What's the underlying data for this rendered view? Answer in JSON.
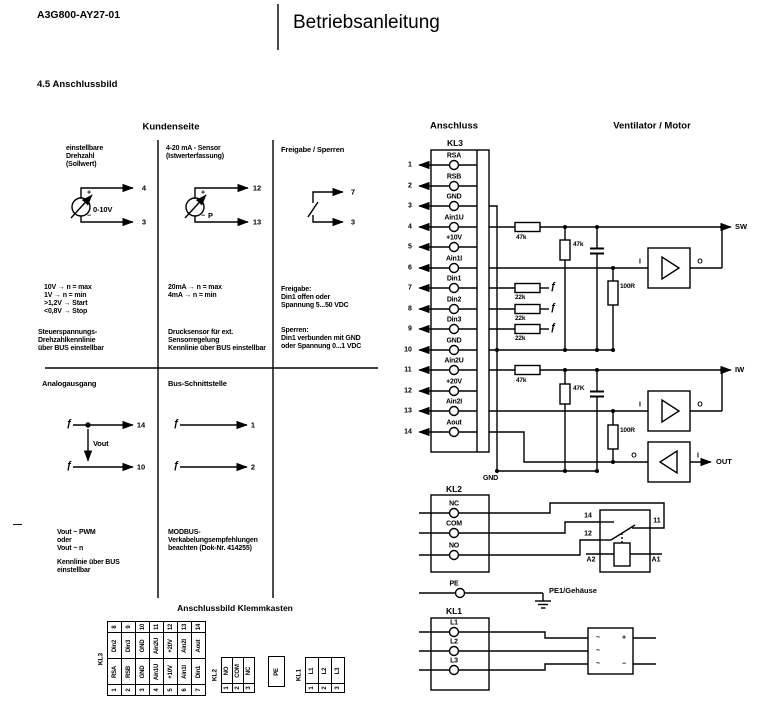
{
  "header": {
    "doc_number": "A3G800-AY27-01",
    "title": "Betriebsanleitung"
  },
  "section_title": "4.5 Anschlussbild",
  "glyphs": {
    "switch": "ƒ",
    "plus": "+",
    "minus": "−",
    "tilde": "~",
    "dash": "—"
  },
  "kundenseite": {
    "heading": "Kundenseite",
    "setpoint": {
      "heading": "einstellbare\nDrehzahl\n(Sollwert)",
      "pot_label": "0-10V",
      "pin_top": "4",
      "pin_bottom": "3",
      "values": "10V  → n = max\n1V  → n = min\n>1,2V → Start\n<0,8V → Stop",
      "note": "Steuerspannungs-\nDrehzahlkennlinie\nüber BUS einstellbar"
    },
    "sensor": {
      "heading": "4-20 mA - Sensor\n(Istwerterfassung)",
      "sensor_label": "P",
      "pin_top": "12",
      "pin_bottom": "13",
      "values": "20mA  → n = max\n4mA  → n = min",
      "note": "Drucksensor für ext.\nSensorregelung\nKennlinie über BUS einstellbar"
    },
    "enable": {
      "heading": "Freigabe / Sperren",
      "pin_top": "7",
      "pin_bottom": "3",
      "values": "Freigabe:\nDin1 offen oder\nSpannung 5...50 VDC",
      "note": "Sperren:\nDin1 verbunden mit GND\noder Spannung 0...1 VDC"
    },
    "analog_out": {
      "heading": "Analogausgang",
      "pin_top": "14",
      "pin_bottom": "10",
      "vout": "Vout",
      "note": "Vout ~ PWM\noder\nVout ~ n",
      "note2": "Kennlinie über BUS\neinstellbar"
    },
    "bus": {
      "heading": "Bus-Schnittstelle",
      "pin_top": "1",
      "pin_bottom": "2",
      "note": "MODBUS-\nVerkabelungsempfehlungen\nbeachten (Dok-Nr. 414255)"
    }
  },
  "anschluss": {
    "heading": "Anschluss",
    "kl3_label": "KL3",
    "kl3": [
      {
        "num": "1",
        "name": "RSA"
      },
      {
        "num": "2",
        "name": "RSB"
      },
      {
        "num": "3",
        "name": "GND"
      },
      {
        "num": "4",
        "name": "Ain1U"
      },
      {
        "num": "5",
        "name": "+10V"
      },
      {
        "num": "6",
        "name": "Ain1I"
      },
      {
        "num": "7",
        "name": "Din1"
      },
      {
        "num": "8",
        "name": "Din2"
      },
      {
        "num": "9",
        "name": "Din3"
      },
      {
        "num": "10",
        "name": "GND"
      },
      {
        "num": "11",
        "name": "Ain2U"
      },
      {
        "num": "12",
        "name": "+20V"
      },
      {
        "num": "13",
        "name": "Ain2I"
      },
      {
        "num": "14",
        "name": "Aout"
      }
    ],
    "r_in1_series": "47k",
    "r_in1_shunt": "47k",
    "r_in1_cur": "100R",
    "r_din1": "22k",
    "r_din2": "22k",
    "r_din3": "22k",
    "r_in2_series": "47k",
    "r_in2_shunt": "47K",
    "r_in2_cur": "100R",
    "amp_in": "I",
    "amp_out": "O",
    "sig_sw": "SW",
    "sig_iw": "IW",
    "sig_out": "OUT",
    "gnd": "GND",
    "kl2_label": "KL2",
    "kl2": [
      "NC",
      "COM",
      "NO"
    ],
    "relay": {
      "c14": "14",
      "c12": "12",
      "c11": "11",
      "a2": "A2",
      "a1": "A1"
    },
    "pe_label": "PE",
    "pe_earth": "PE1/Gehäuse",
    "kl1_label": "KL1",
    "kl1": [
      "L1",
      "L2",
      "L3"
    ],
    "ventilator_heading": "Ventilator / Motor"
  },
  "klemmkasten": {
    "heading": "Anschlussbild Klemmkasten",
    "kl3_label": "KL3",
    "kl3_top_nums": [
      "8",
      "9",
      "10",
      "11",
      "12",
      "13",
      "14"
    ],
    "kl3_top_names": [
      "Din2",
      "Din3",
      "GND",
      "Ain2U",
      "+20V",
      "Ain2I",
      "Aout"
    ],
    "kl3_bot_names": [
      "RSA",
      "RSB",
      "GND",
      "Ain1U",
      "+10V",
      "Ain1I",
      "Din1"
    ],
    "kl3_bot_nums": [
      "1",
      "2",
      "3",
      "4",
      "5",
      "6",
      "7"
    ],
    "kl2_label": "KL2",
    "kl2_names": [
      "NO",
      "COM",
      "NC"
    ],
    "kl2_nums": [
      "1",
      "2",
      "3"
    ],
    "pe": "PE",
    "kl1_label": "KL1",
    "kl1_names": [
      "L1",
      "L2",
      "L3"
    ],
    "kl1_nums": [
      "1",
      "2",
      "3"
    ]
  }
}
